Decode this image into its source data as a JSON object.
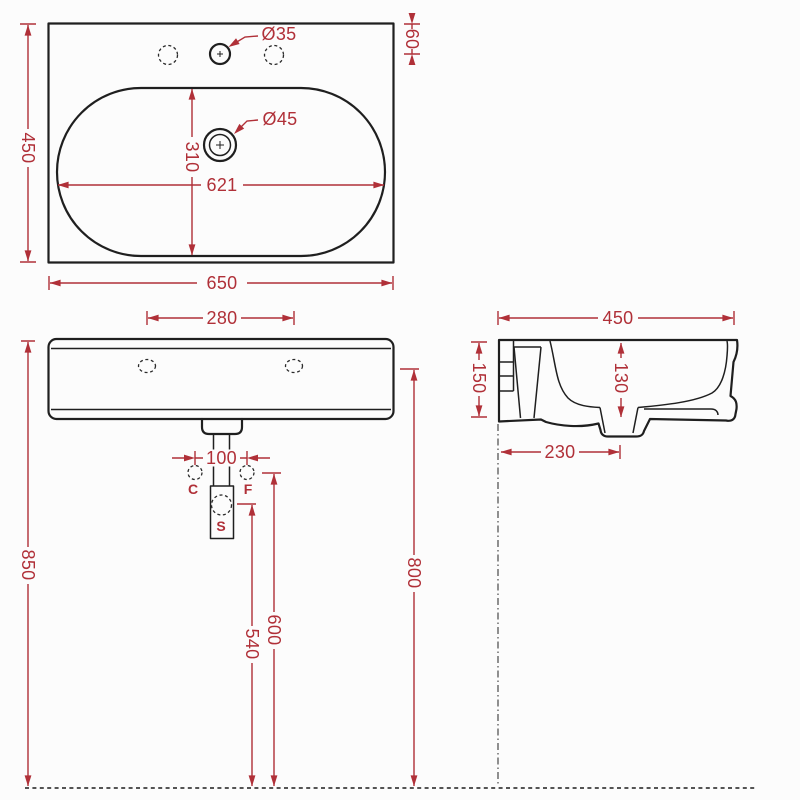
{
  "drawing": {
    "type": "washbasin technical dimension drawing",
    "colors": {
      "dimension_red": "#b03038",
      "outline_black": "#1f1f1f",
      "background": "#fcfcfc"
    },
    "top_view": {
      "overall_width": "650",
      "overall_depth": "450",
      "bowl_width": "621",
      "bowl_depth": "310",
      "tap_hole_offset": "60",
      "tap_hole_diameter": "Ø35",
      "drain_diameter": "Ø45"
    },
    "front_view": {
      "fixing_hole_spacing": "280",
      "supply_spacing": "100",
      "rim_height": "850",
      "fixing_hole_height": "800",
      "supply_height": "600",
      "siphon_height": "540",
      "label_c": "C",
      "label_f": "F",
      "label_s": "S"
    },
    "side_view": {
      "overall_depth": "450",
      "edge_height": "150",
      "bowl_inner_depth": "130",
      "drain_to_wall": "230"
    }
  }
}
